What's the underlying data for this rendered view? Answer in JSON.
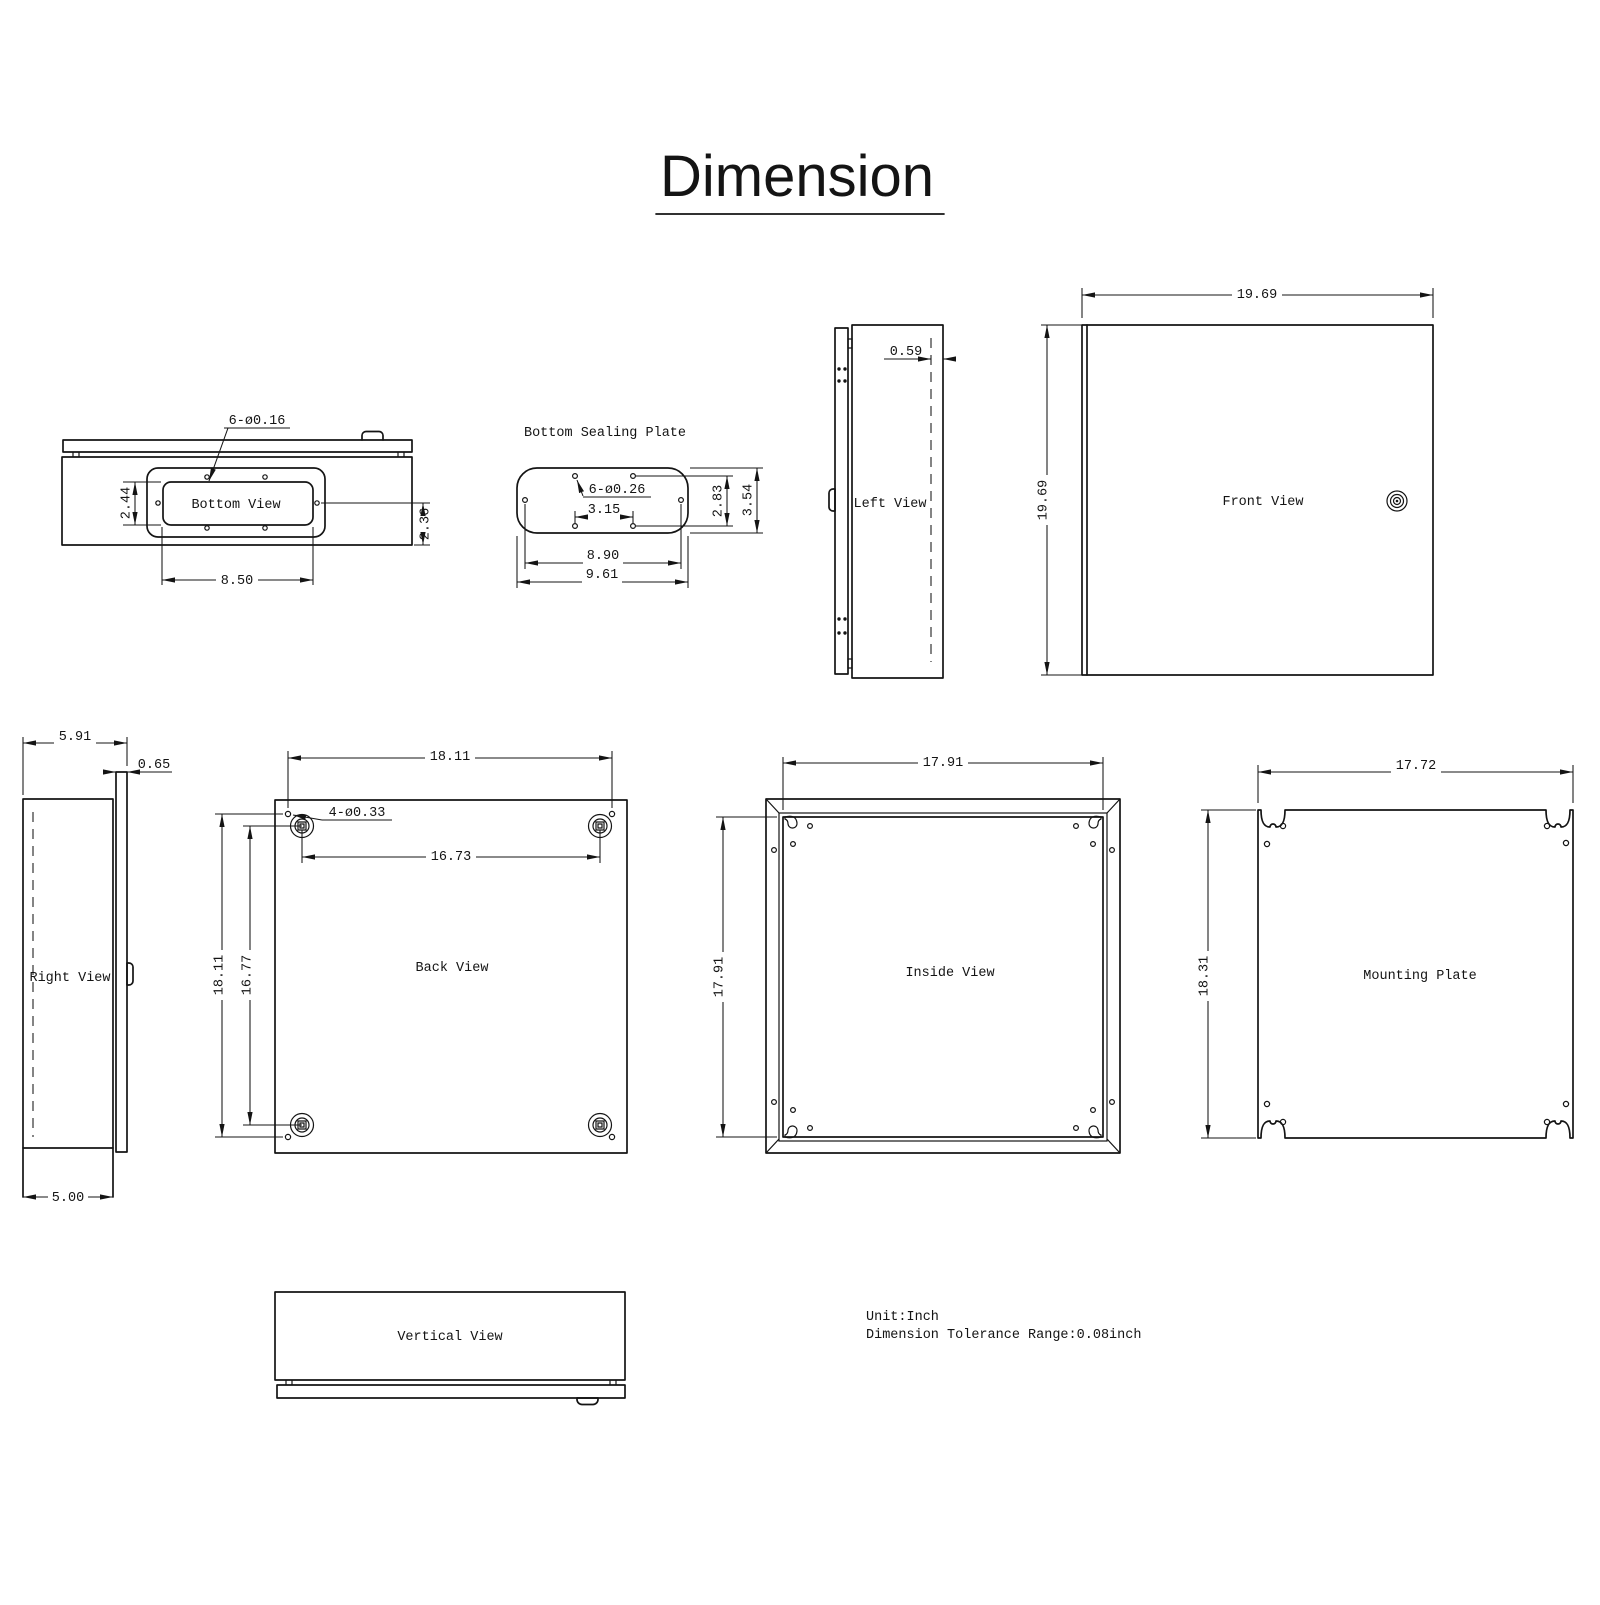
{
  "title": "Dimension",
  "notes": {
    "unit": "Unit:Inch",
    "tolerance": "Dimension Tolerance Range:0.08inch"
  },
  "views": {
    "bottom": {
      "label": "Bottom View",
      "hole_callout": "6-ø0.16",
      "dim_cutout_height": "2.44",
      "dim_cutout_width": "8.50",
      "dim_edge_offset": "2.36"
    },
    "sealing_plate": {
      "label": "Bottom Sealing Plate",
      "hole_callout": "6-ø0.26",
      "dim_center_holes": "3.15",
      "dim_hole_rows": "2.83",
      "dim_height": "3.54",
      "dim_hole_span": "8.90",
      "dim_width": "9.61"
    },
    "left": {
      "label": "Left View",
      "dim_door_inset": "0.59"
    },
    "front": {
      "label": "Front View",
      "dim_width": "19.69",
      "dim_height": "19.69"
    },
    "right": {
      "label": "Right View",
      "dim_depth_total": "5.91",
      "dim_door_thickness": "0.65",
      "dim_depth_body": "5.00"
    },
    "back": {
      "label": "Back View",
      "hole_callout": "4-ø0.33",
      "dim_hole_span_h": "18.11",
      "dim_boss_span_h": "16.73",
      "dim_hole_span_v": "18.11",
      "dim_boss_span_v": "16.77"
    },
    "inside": {
      "label": "Inside View",
      "dim_width": "17.91",
      "dim_height": "17.91"
    },
    "mounting": {
      "label": "Mounting Plate",
      "dim_width": "17.72",
      "dim_height": "18.31"
    },
    "vertical": {
      "label": "Vertical View"
    }
  }
}
